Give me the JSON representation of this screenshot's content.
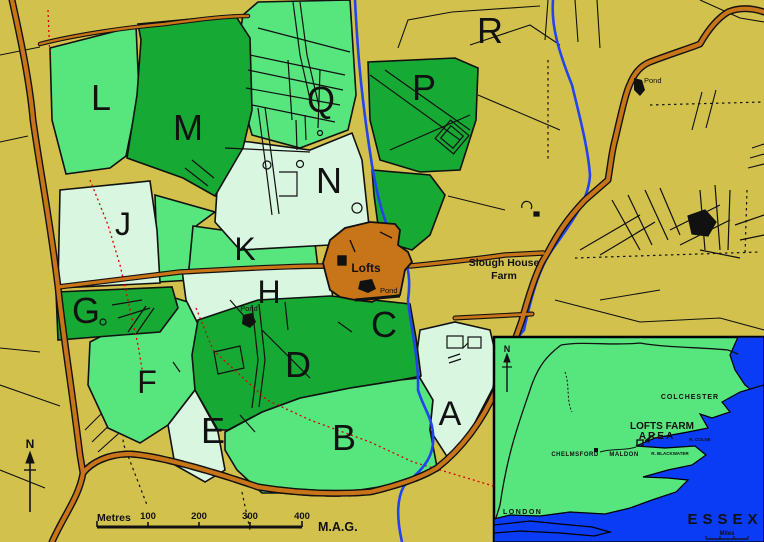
{
  "colors": {
    "background_tan": "#d3c14e",
    "field_pale_green": "#d9f6e0",
    "field_medium_green": "#57e57e",
    "field_dark_green": "#16a934",
    "road_orange": "#c87418",
    "settlement_orange": "#c87418",
    "stream_blue": "#2244ee",
    "inset_sea_blue": "#0a3cf5",
    "parish_boundary_red": "#dd0000",
    "line_black": "#111111"
  },
  "fields": {
    "a": "A",
    "b": "B",
    "c": "C",
    "d": "D",
    "e": "E",
    "f": "F",
    "g": "G",
    "h": "H",
    "j": "J",
    "k": "K",
    "l": "L",
    "m": "M",
    "n": "N",
    "p": "P",
    "q": "Q",
    "r": "R"
  },
  "labels": {
    "lofts": "Lofts",
    "slough_house_line1": "Slough House",
    "slough_house_line2": "Farm",
    "pond": "Pond",
    "north": "N"
  },
  "scale_bar": {
    "unit": "Metres",
    "tick_100": "100",
    "tick_200": "200",
    "tick_300": "300",
    "tick_400": "400",
    "attribution": "M.A.G."
  },
  "inset": {
    "north": "N",
    "region_title": "ESSEX",
    "scale_unit": "Miles",
    "labels": {
      "colchester": "COLCHESTER",
      "lofts_farm_line1": "LOFTS FARM",
      "lofts_farm_line2": "AREA",
      "chelmsford": "CHELMSFORD",
      "maldon": "MALDON",
      "london": "LONDON",
      "river_blackwater": "R. BLACKWATER",
      "river_colne": "R. COLNE"
    }
  }
}
